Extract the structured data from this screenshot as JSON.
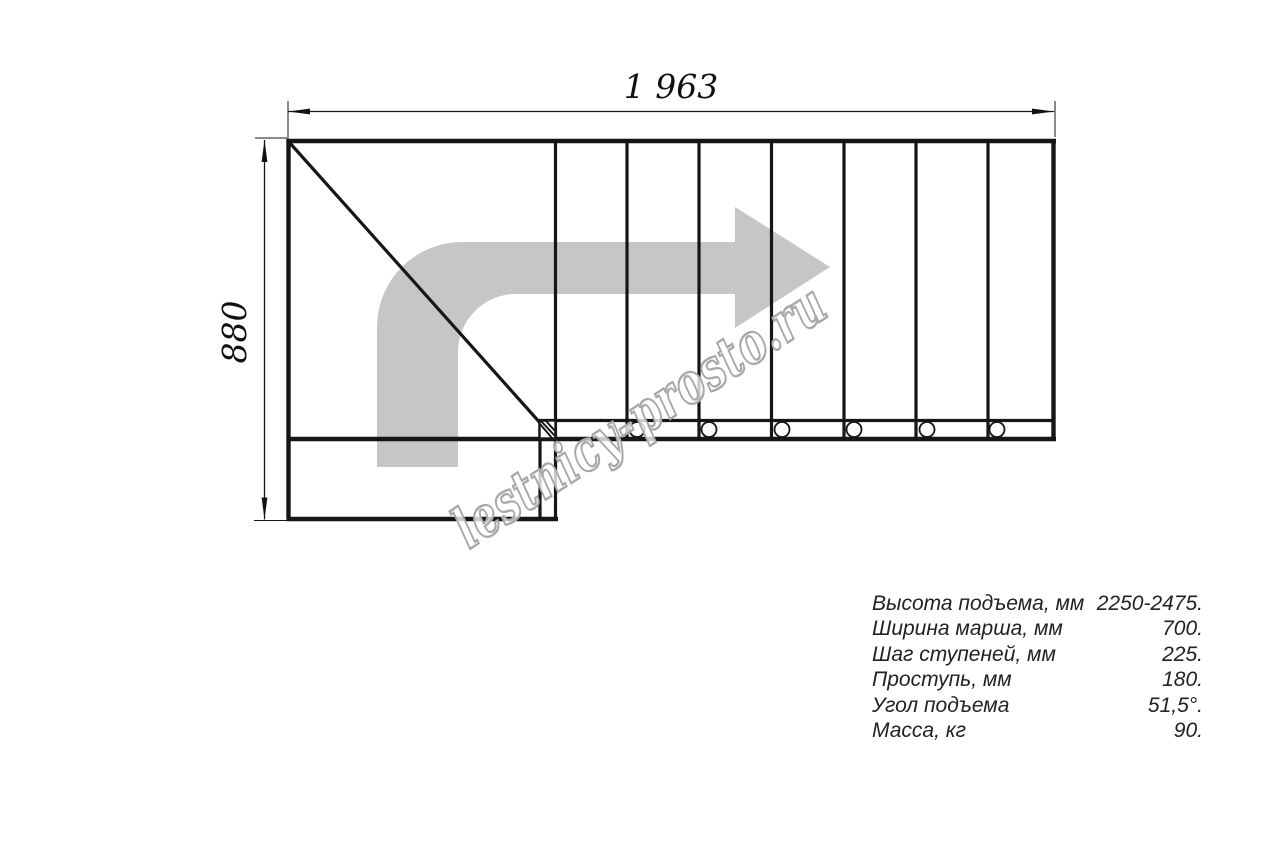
{
  "drawing": {
    "top_dimension": "1 963",
    "left_dimension": "880",
    "watermark": "lestnicy-prosto.ru"
  },
  "specs": {
    "rows": [
      {
        "label": "Высота подъема, мм",
        "value": "2250-2475."
      },
      {
        "label": "Ширина марша, мм",
        "value": "700."
      },
      {
        "label": "Шаг ступеней, мм",
        "value": "225."
      },
      {
        "label": "Проступь, мм",
        "value": "180."
      },
      {
        "label": "Угол подъема",
        "value": "51,5°."
      },
      {
        "label": "Масса, кг",
        "value": "90."
      }
    ]
  },
  "colors": {
    "line": "#161616",
    "arrow_fill": "#c6c6c6",
    "watermark_stroke": "#a8a8a8",
    "spec_text": "#222222"
  }
}
